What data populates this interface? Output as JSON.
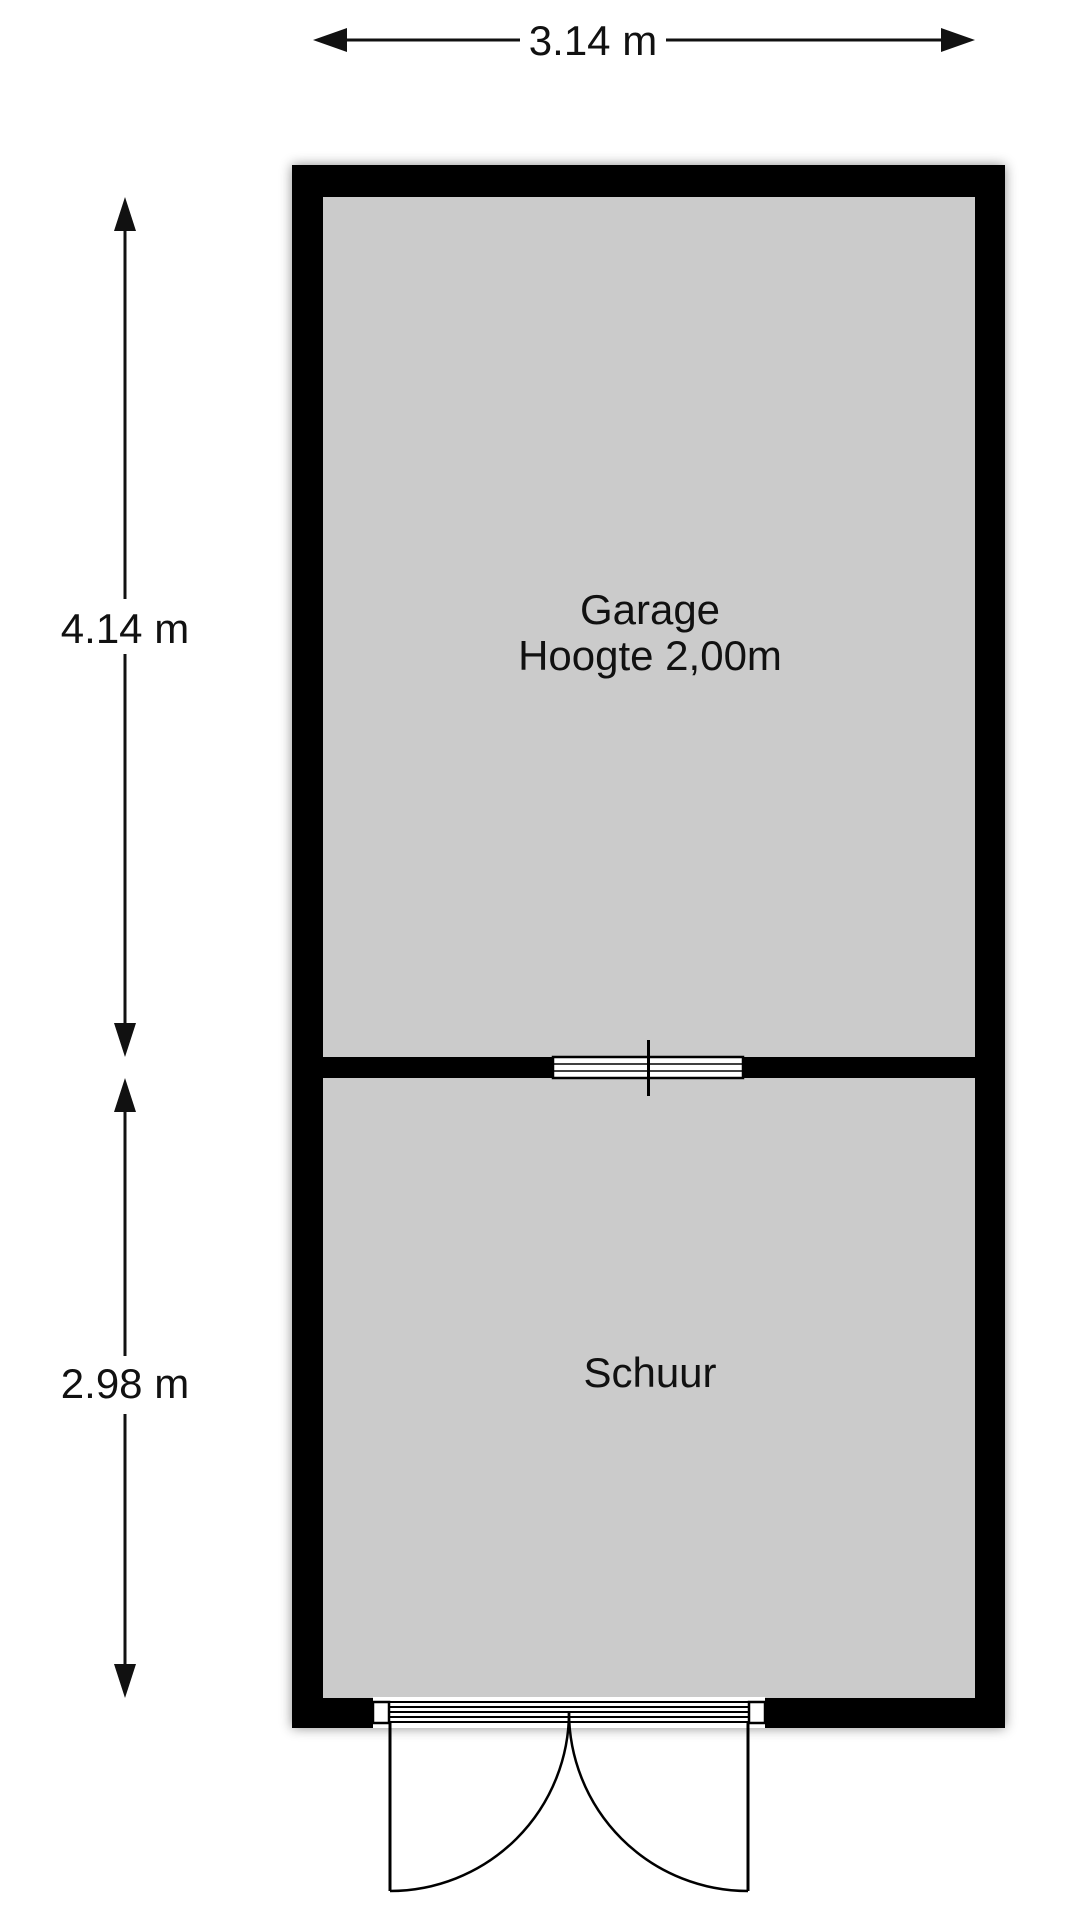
{
  "plan": {
    "type": "floorplan",
    "rooms": {
      "garage": {
        "name": "Garage",
        "height_note": "Hoogte 2,00m"
      },
      "schuur": {
        "name": "Schuur"
      }
    },
    "dimensions": {
      "width_label": "3.14 m",
      "garage_depth_label": "4.14 m",
      "schuur_depth_label": "2.98 m"
    },
    "colors": {
      "wall": "#000000",
      "floor": "#cbcbcb",
      "line": "#111111",
      "background": "#ffffff"
    }
  }
}
